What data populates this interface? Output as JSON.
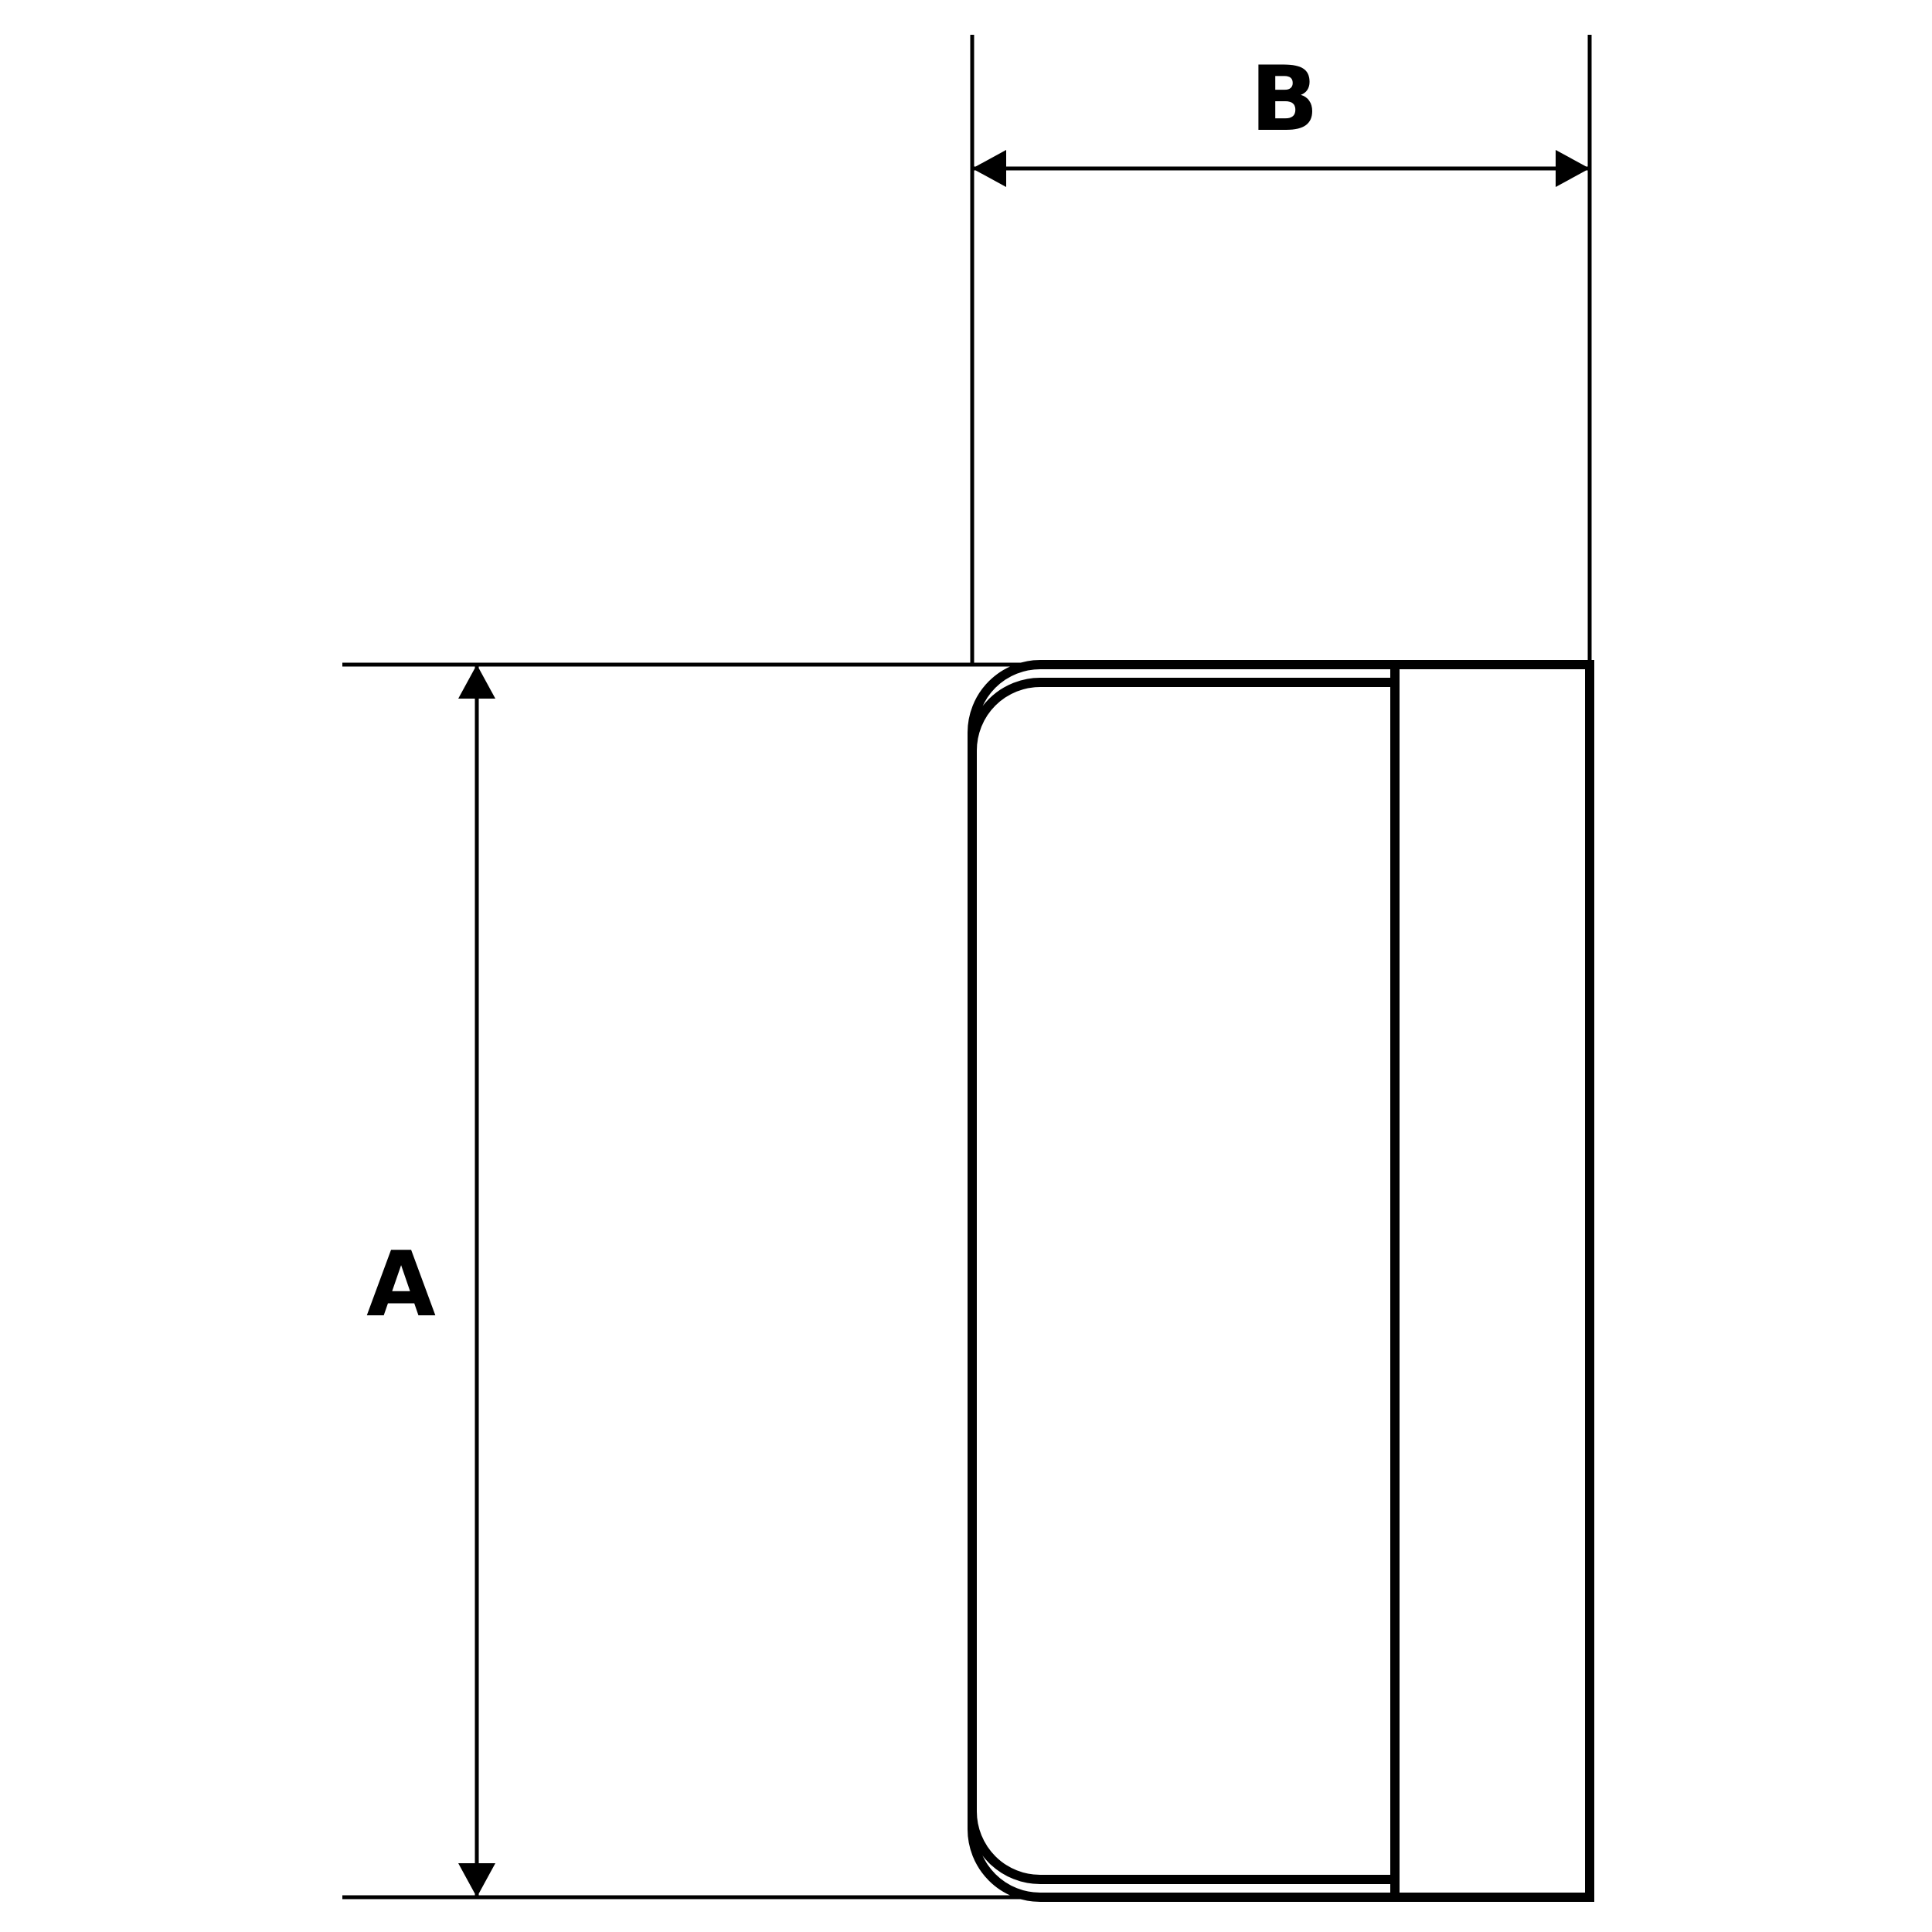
{
  "page": {
    "background": "#ffffff"
  },
  "drawing": {
    "line_color": "#000000",
    "dimension_horizontal": {
      "label": "B"
    },
    "dimension_vertical": {
      "label": "A"
    }
  }
}
